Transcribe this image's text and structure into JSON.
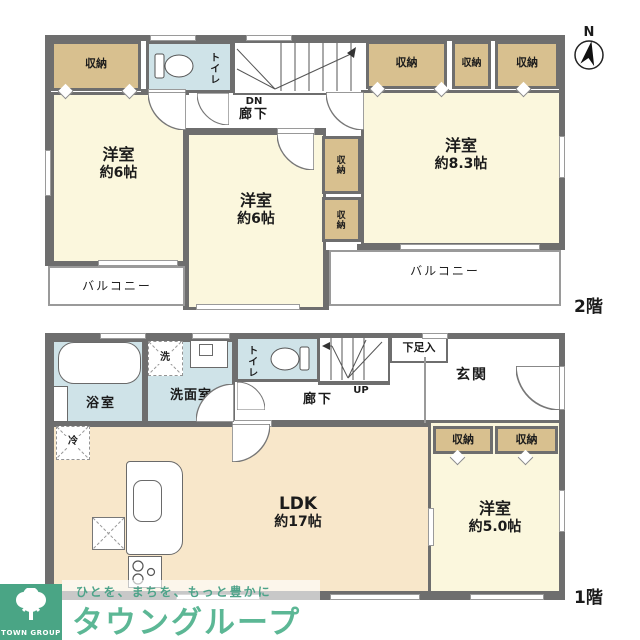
{
  "compass": {
    "north": "N"
  },
  "colors": {
    "wall": "#6e6e6e",
    "cream": "#fbf7dd",
    "peach": "#f8e7ca",
    "tan": "#d8c08f",
    "blue": "#cfe3e8",
    "green": "#4aa585",
    "brandgreen": "#5cb795"
  },
  "floor2": {
    "label": "2階",
    "closet_nw": "収納",
    "toilet": "トイレ",
    "dn": "DN",
    "hall": "廊下",
    "closets_ne": [
      "収納",
      "収納",
      "収納"
    ],
    "closets_mid": [
      "収納",
      "収納"
    ],
    "room_west": {
      "name": "洋室",
      "size": "約6帖"
    },
    "room_center": {
      "name": "洋室",
      "size": "約6帖"
    },
    "room_east": {
      "name": "洋室",
      "size": "約8.3帖"
    },
    "balcony_west": "バルコニー",
    "balcony_east": "バルコニー"
  },
  "floor1": {
    "label": "1階",
    "bath": "浴室",
    "washer": "洗",
    "washroom": "洗面室",
    "toilet": "トイレ",
    "up": "UP",
    "hall": "廊下",
    "shoebox": "下足入",
    "entrance": "玄関",
    "fridge": "冷",
    "ldk": {
      "name": "LDK",
      "size": "約17帖"
    },
    "closets": [
      "収納",
      "収納"
    ],
    "room_east": {
      "name": "洋室",
      "size": "約5.0帖"
    }
  },
  "logo": {
    "org": "TOWN GROUP",
    "tagline": "ひとを、まちを、もっと豊かに",
    "brand": "タウングループ"
  }
}
